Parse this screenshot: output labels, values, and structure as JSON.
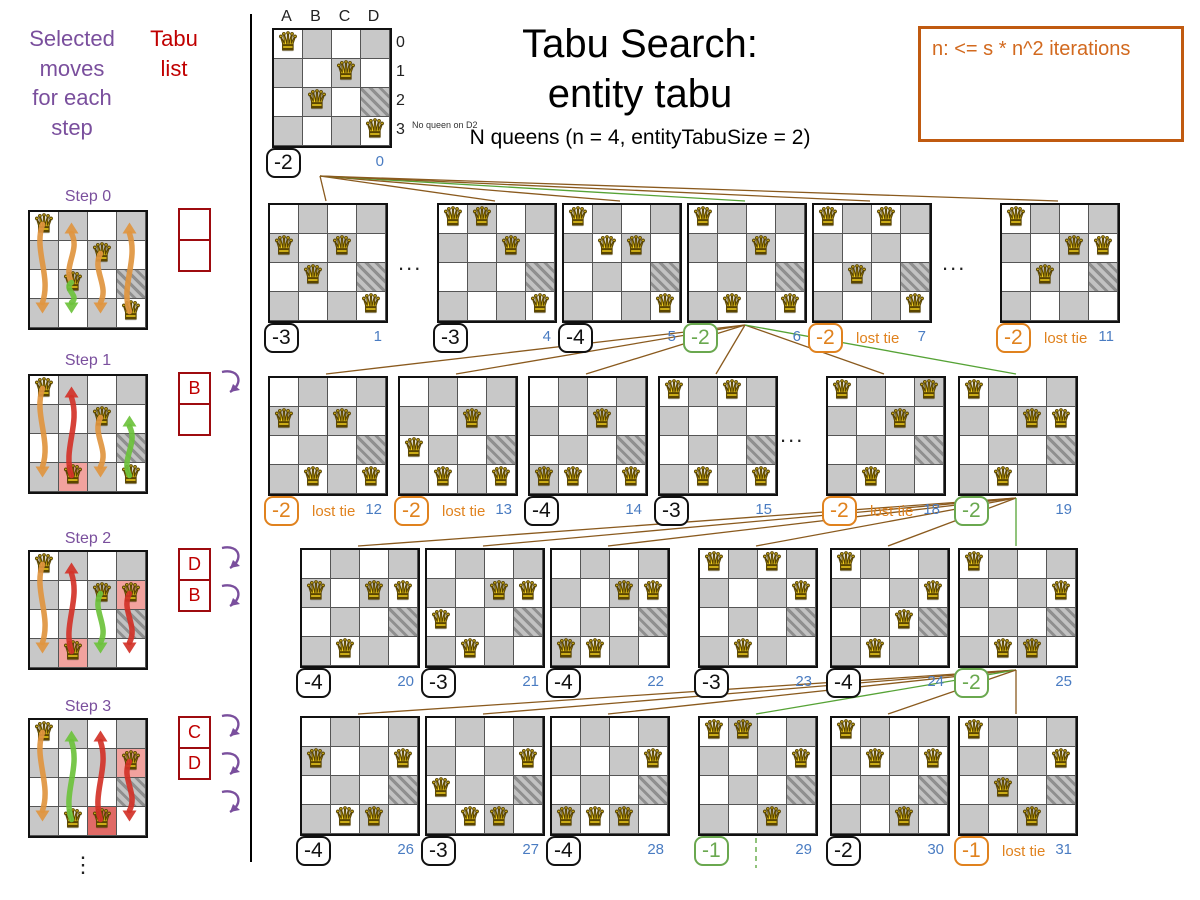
{
  "header": {
    "title_line1": "Tabu Search:",
    "title_line2": "entity tabu",
    "subtitle": "N queens (n = 4, entityTabuSize = 2)"
  },
  "note_box": {
    "text": "n: <= s * n^2 iterations"
  },
  "left_panel": {
    "moves_header": "Selected\nmoves\nfor each\nstep",
    "tabu_header": "Tabu\nlist",
    "vertical_ellipsis": "⋮",
    "steps": [
      {
        "label": "Step 0",
        "queens": [
          "A0",
          "C1",
          "B2",
          "D3"
        ],
        "highlights": {},
        "tabu": [
          "",
          ""
        ],
        "arrows": [
          {
            "col": "A",
            "from": 0,
            "to": 3,
            "color": "orange"
          },
          {
            "col": "B",
            "from": 2,
            "to": 0,
            "color": "orange"
          },
          {
            "col": "C",
            "from": 1,
            "to": 3,
            "color": "orange"
          },
          {
            "col": "D",
            "from": 3,
            "to": 0,
            "color": "orange"
          },
          {
            "col": "B",
            "from": 2,
            "to": 3,
            "color": "green"
          }
        ],
        "tabu_arrow_count": 0
      },
      {
        "label": "Step 1",
        "queens": [
          "A0",
          "C1",
          "B3",
          "D3"
        ],
        "highlights": {
          "B3": "pink"
        },
        "tabu": [
          "B",
          ""
        ],
        "arrows": [
          {
            "col": "A",
            "from": 0,
            "to": 3,
            "color": "orange"
          },
          {
            "col": "C",
            "from": 1,
            "to": 3,
            "color": "orange"
          },
          {
            "col": "B",
            "from": 3,
            "to": 0,
            "color": "red"
          },
          {
            "col": "D",
            "from": 3,
            "to": 1,
            "color": "green"
          }
        ],
        "tabu_arrow_count": 1
      },
      {
        "label": "Step 2",
        "queens": [
          "A0",
          "C1",
          "D1",
          "B3"
        ],
        "highlights": {
          "B3": "pink",
          "D1": "pink"
        },
        "tabu": [
          "D",
          "B"
        ],
        "arrows": [
          {
            "col": "A",
            "from": 0,
            "to": 3,
            "color": "orange"
          },
          {
            "col": "B",
            "from": 3,
            "to": 0,
            "color": "red"
          },
          {
            "col": "D",
            "from": 1,
            "to": 3,
            "color": "red"
          },
          {
            "col": "C",
            "from": 1,
            "to": 3,
            "color": "green"
          }
        ],
        "tabu_arrow_count": 2
      },
      {
        "label": "Step 3",
        "queens": [
          "A0",
          "D1",
          "B3",
          "C3"
        ],
        "highlights": {
          "D1": "pink",
          "C3": "red"
        },
        "tabu": [
          "C",
          "D"
        ],
        "arrows": [
          {
            "col": "A",
            "from": 0,
            "to": 3,
            "color": "orange"
          },
          {
            "col": "C",
            "from": 3,
            "to": 0,
            "color": "red"
          },
          {
            "col": "D",
            "from": 1,
            "to": 3,
            "color": "red"
          },
          {
            "col": "B",
            "from": 3,
            "to": 0,
            "color": "green"
          }
        ],
        "tabu_arrow_count": 3
      }
    ]
  },
  "root_board": {
    "col_labels": [
      "A",
      "B",
      "C",
      "D"
    ],
    "row_labels": [
      "0",
      "1",
      "2",
      "3"
    ],
    "queens": [
      "A0",
      "C1",
      "B2",
      "D3"
    ],
    "hatched": "D2",
    "annotation": "No queen on D2",
    "score": "-2",
    "index": "0"
  },
  "tree": {
    "ellipsis": "...",
    "lost_tie_label": "lost tie",
    "rows": [
      {
        "boards": [
          {
            "index": "1",
            "score": "-3",
            "variant": "normal",
            "queens": [
              "A1",
              "C1",
              "B2",
              "D3"
            ]
          },
          {
            "index": "4",
            "score": "-3",
            "variant": "normal",
            "queens": [
              "A0",
              "B0",
              "C1",
              "D3"
            ]
          },
          {
            "index": "5",
            "score": "-4",
            "variant": "normal",
            "queens": [
              "A0",
              "B1",
              "C1",
              "D3"
            ]
          },
          {
            "index": "6",
            "score": "-2",
            "variant": "selected",
            "queens": [
              "A0",
              "C1",
              "B3",
              "D3"
            ]
          },
          {
            "index": "7",
            "score": "-2",
            "variant": "lost_tie",
            "queens": [
              "A0",
              "C0",
              "B2",
              "D3"
            ]
          },
          {
            "index": "11",
            "score": "-2",
            "variant": "lost_tie",
            "queens": [
              "A0",
              "C1",
              "D1",
              "B2"
            ]
          }
        ]
      },
      {
        "boards": [
          {
            "index": "12",
            "score": "-2",
            "variant": "lost_tie",
            "queens": [
              "A1",
              "C1",
              "B3",
              "D3"
            ]
          },
          {
            "index": "13",
            "score": "-2",
            "variant": "lost_tie",
            "queens": [
              "A2",
              "C1",
              "B3",
              "D3"
            ]
          },
          {
            "index": "14",
            "score": "-4",
            "variant": "normal",
            "queens": [
              "A3",
              "C1",
              "B3",
              "D3"
            ]
          },
          {
            "index": "15",
            "score": "-3",
            "variant": "normal",
            "queens": [
              "A0",
              "C0",
              "B3",
              "D3"
            ]
          },
          {
            "index": "18",
            "score": "-2",
            "variant": "lost_tie",
            "queens": [
              "A0",
              "D0",
              "C1",
              "B3"
            ]
          },
          {
            "index": "19",
            "score": "-2",
            "variant": "selected",
            "queens": [
              "A0",
              "C1",
              "D1",
              "B3"
            ]
          }
        ]
      },
      {
        "boards": [
          {
            "index": "20",
            "score": "-4",
            "variant": "normal",
            "queens": [
              "A1",
              "C1",
              "D1",
              "B3"
            ]
          },
          {
            "index": "21",
            "score": "-3",
            "variant": "normal",
            "queens": [
              "A2",
              "C1",
              "D1",
              "B3"
            ]
          },
          {
            "index": "22",
            "score": "-4",
            "variant": "normal",
            "queens": [
              "A3",
              "C1",
              "D1",
              "B3"
            ]
          },
          {
            "index": "23",
            "score": "-3",
            "variant": "normal",
            "queens": [
              "A0",
              "C0",
              "D1",
              "B3"
            ]
          },
          {
            "index": "24",
            "score": "-4",
            "variant": "normal",
            "queens": [
              "A0",
              "C2",
              "D1",
              "B3"
            ]
          },
          {
            "index": "25",
            "score": "-2",
            "variant": "selected",
            "queens": [
              "A0",
              "C3",
              "D1",
              "B3"
            ]
          }
        ]
      },
      {
        "boards": [
          {
            "index": "26",
            "score": "-4",
            "variant": "normal",
            "queens": [
              "A1",
              "C3",
              "D1",
              "B3"
            ]
          },
          {
            "index": "27",
            "score": "-3",
            "variant": "normal",
            "queens": [
              "A2",
              "C3",
              "D1",
              "B3"
            ]
          },
          {
            "index": "28",
            "score": "-4",
            "variant": "normal",
            "queens": [
              "A3",
              "C3",
              "D1",
              "B3"
            ]
          },
          {
            "index": "29",
            "score": "-1",
            "variant": "selected",
            "queens": [
              "A0",
              "B0",
              "C3",
              "D1"
            ]
          },
          {
            "index": "30",
            "score": "-2",
            "variant": "normal",
            "queens": [
              "A0",
              "B1",
              "C3",
              "D1"
            ]
          },
          {
            "index": "31",
            "score": "-1",
            "variant": "lost_tie",
            "queens": [
              "A0",
              "B2",
              "C3",
              "D1"
            ]
          }
        ]
      }
    ]
  },
  "colors": {
    "purple": "#7a4f9d",
    "tabu_red": "#c00000",
    "score_green": "#6aa84f",
    "score_orange": "#e0821e",
    "index_blue": "#4a7cc2",
    "line_brown": "#8a5a1e",
    "line_green": "#56a336",
    "arrow_orange": "#e0953f",
    "arrow_red": "#d23228",
    "arrow_green": "#6cc23c"
  }
}
